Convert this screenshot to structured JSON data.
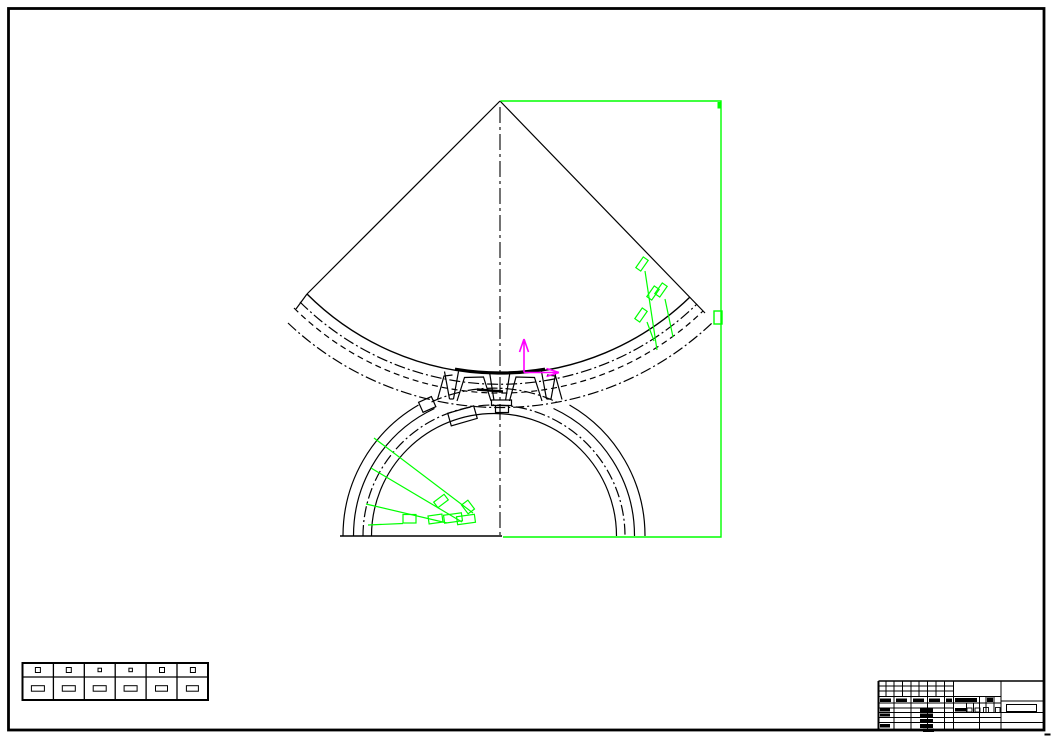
{
  "sheet": {
    "type": "cad-drawing-sheet",
    "description": "Engineering drawing of a gear mesh: large gear sector (apex at top) engaging a pinion rim below; no legible text on sheet",
    "width_px": 1052,
    "height_px": 738
  },
  "colors": {
    "background": "#ffffff",
    "drawing": "#000000",
    "highlight": "#00ff00",
    "ucs": "#ff00ff"
  },
  "views": {
    "sector_gear": "gear sector with straight flanks at 45 deg and concentric tip/pitch/root arcs",
    "pinion": "semicircular pinion rim with four concentric arcs cut by horizontal base line",
    "mesh_zone": "meshing teeth at drawing center on vertical dash-dot centerline"
  },
  "selection": {
    "rectangle_note": "green window from sector apex to lower right corner",
    "sector_tag_count": 4,
    "pinion_leader_count": 4,
    "grip_note": "small green grip box on right edge"
  },
  "ucs_icon": {
    "axes": [
      "x-right",
      "y-up"
    ]
  },
  "parameter_table": {
    "rows": 2,
    "columns": 6,
    "cell_text": "illegible at this scale"
  },
  "title_block": {
    "position": "bottom-right",
    "text": "illegible at this scale"
  }
}
